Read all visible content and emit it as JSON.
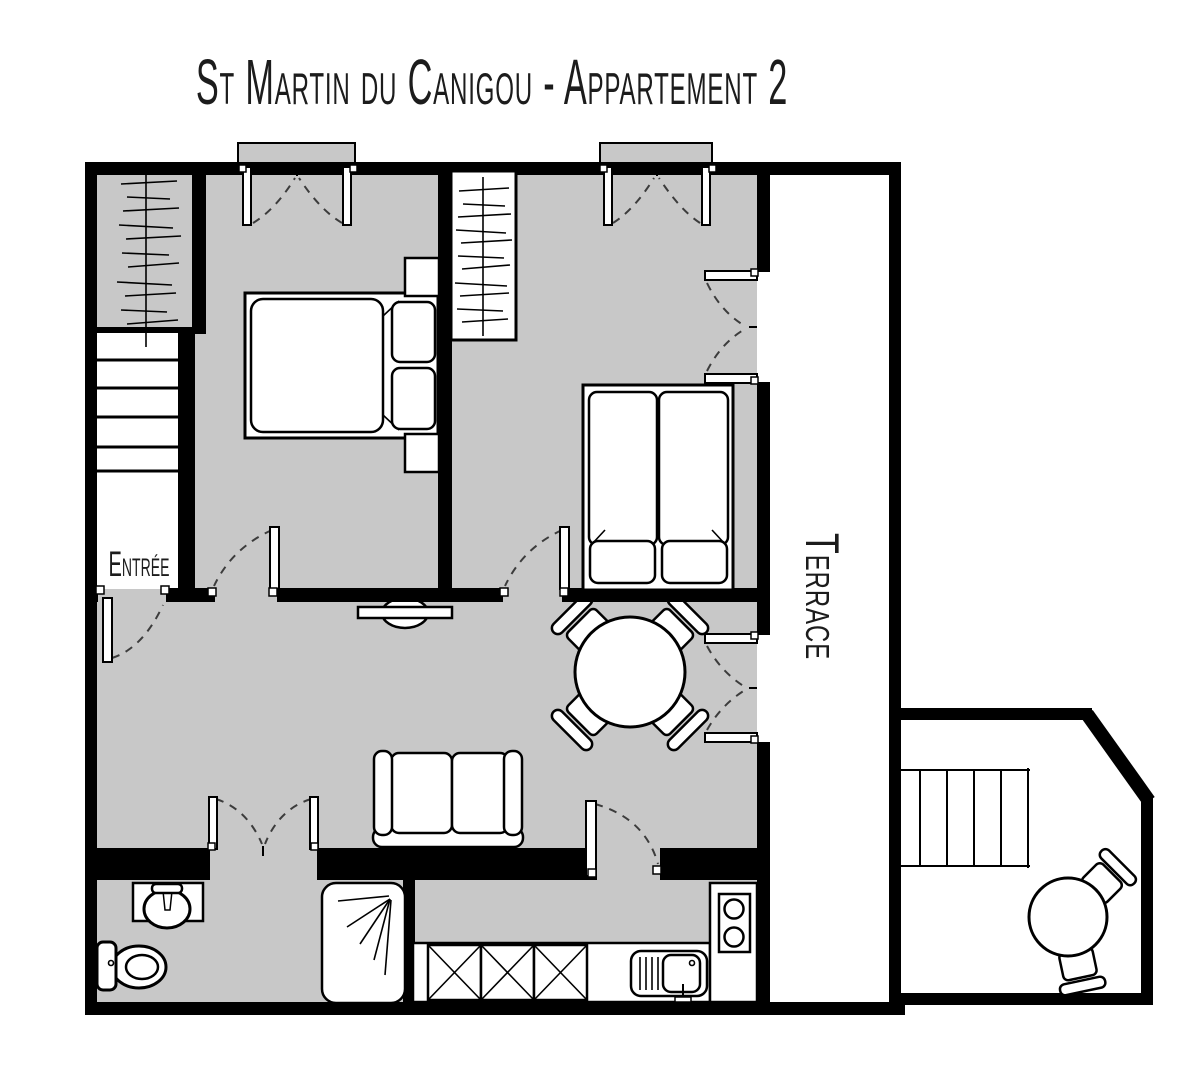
{
  "title": "St Martin du Canigou - Appartement 2",
  "labels": {
    "entrance": "Entrée",
    "terrace": "Terrace"
  },
  "colors": {
    "background": "#ffffff",
    "floor": "#c8c8c8",
    "wall": "#000000",
    "line": "#000000"
  },
  "plan": {
    "apartment": "Appartement 2",
    "rooms": [
      "bedroom-1",
      "bedroom-2",
      "living-dining-room",
      "bathroom",
      "kitchen",
      "entrance-stairs",
      "terrace",
      "lower-terrace"
    ],
    "icons": [
      "double-bed",
      "twin-beds",
      "nightstand",
      "wardrobe-clothes-rail",
      "stairs",
      "dining-table",
      "chair",
      "sofa",
      "console-table",
      "toilet",
      "washbasin",
      "shower",
      "kitchen-sink",
      "stove-hob",
      "terrace-table",
      "door-swing",
      "french-window"
    ]
  }
}
